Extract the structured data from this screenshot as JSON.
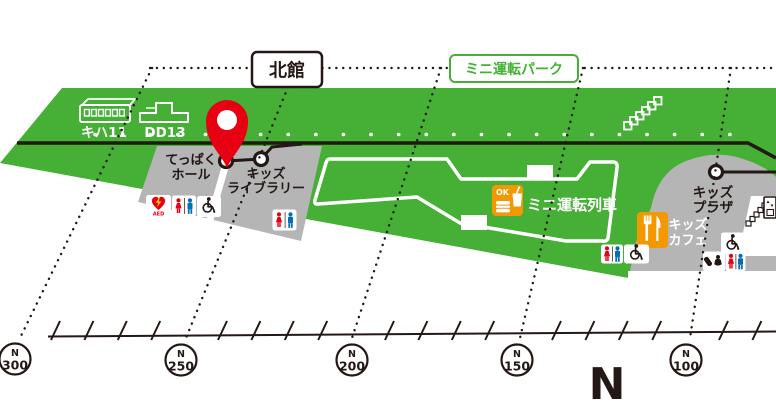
{
  "map": {
    "building_label": "北館",
    "park_label": "ミニ運転パーク",
    "trains": {
      "kiha11": "キハ11",
      "dd13": "DD13"
    },
    "areas": {
      "teppaku_hall": {
        "line1": "てっぱく",
        "line2": "ホール"
      },
      "kids_library": {
        "line1": "キッズ",
        "line2": "ライブラリー"
      },
      "mini_drive_train": "ミニ運転列車",
      "kids_cafe": {
        "line1": "キッズ",
        "line2": "カフェ"
      },
      "kids_plaza": {
        "line1": "キッズ",
        "line2": "プラザ"
      }
    },
    "badges": {
      "aed": "AED",
      "food_ok": "OK"
    }
  },
  "scale": {
    "compass": "N",
    "markers": [
      {
        "prefix": "N",
        "value": "300"
      },
      {
        "prefix": "N",
        "value": "250"
      },
      {
        "prefix": "N",
        "value": "200"
      },
      {
        "prefix": "N",
        "value": "150"
      },
      {
        "prefix": "N",
        "value": "100"
      }
    ]
  },
  "colors": {
    "green": "#45b035",
    "gray": "#b5b5b6",
    "dark": "#231815",
    "red": "#e60012",
    "orange": "#f39800",
    "blue": "#036eb7",
    "yellow": "#ffd800"
  }
}
